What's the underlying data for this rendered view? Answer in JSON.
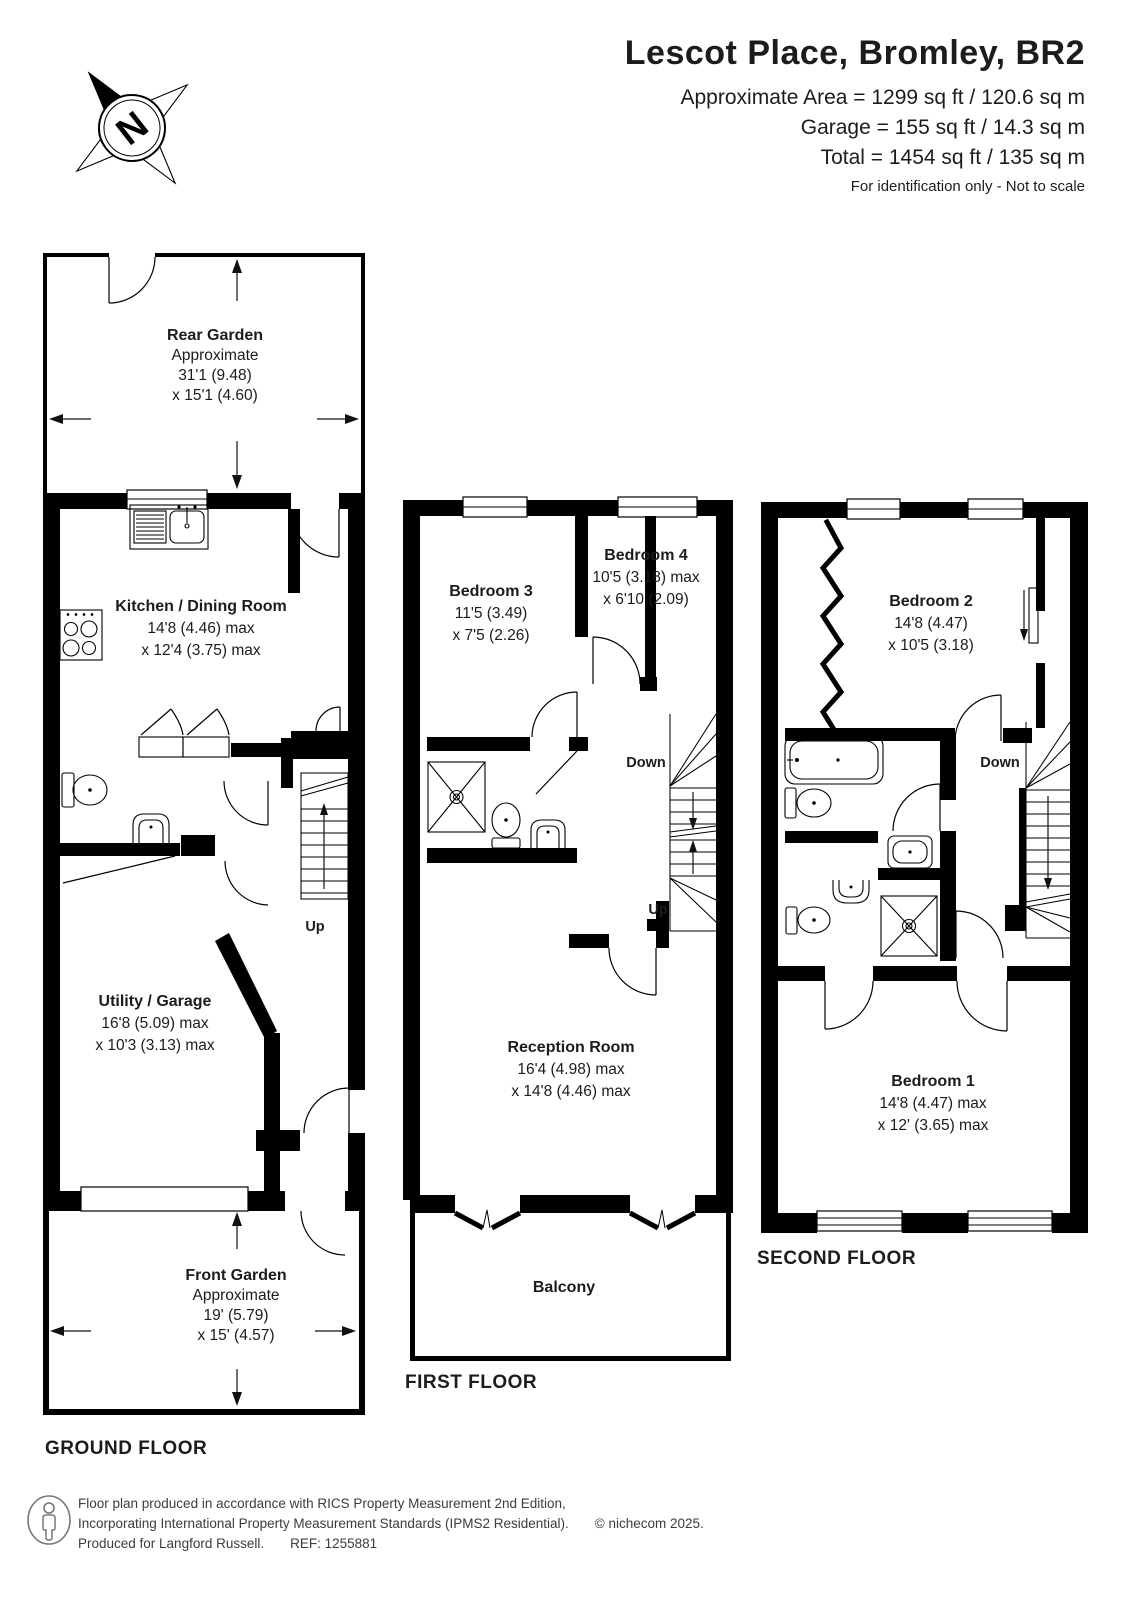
{
  "header": {
    "title": "Lescot Place, Bromley, BR2",
    "area_line1": "Approximate Area = 1299 sq ft / 120.6 sq m",
    "area_line2": "Garage = 155 sq ft / 14.3 sq m",
    "area_line3": "Total = 1454 sq ft / 135 sq m",
    "disclaimer": "For identification only - Not to scale"
  },
  "compass": {
    "north_label": "N"
  },
  "floors": {
    "ground": {
      "label": "GROUND FLOOR",
      "up_label": "Up",
      "rooms": {
        "rear_garden": {
          "name": "Rear Garden",
          "lines": [
            "Approximate",
            "31'1 (9.48)",
            "x 15'1 (4.60)"
          ]
        },
        "kitchen": {
          "name": "Kitchen / Dining Room",
          "lines": [
            "14'8 (4.46) max",
            "x 12'4 (3.75) max"
          ]
        },
        "utility": {
          "name": "Utility / Garage",
          "lines": [
            "16'8 (5.09) max",
            "x 10'3 (3.13) max"
          ]
        },
        "front_garden": {
          "name": "Front Garden",
          "lines": [
            "Approximate",
            "19' (5.79)",
            "x 15' (4.57)"
          ]
        }
      }
    },
    "first": {
      "label": "FIRST FLOOR",
      "down_label": "Down",
      "up_label": "Up",
      "rooms": {
        "bedroom3": {
          "name": "Bedroom 3",
          "lines": [
            "11'5 (3.49)",
            "x 7'5 (2.26)"
          ]
        },
        "bedroom4": {
          "name": "Bedroom 4",
          "lines": [
            "10'5 (3.18) max",
            "x 6'10 (2.09)"
          ]
        },
        "reception": {
          "name": "Reception Room",
          "lines": [
            "16'4 (4.98) max",
            "x 14'8 (4.46) max"
          ]
        },
        "balcony": {
          "name": "Balcony"
        }
      }
    },
    "second": {
      "label": "SECOND FLOOR",
      "down_label": "Down",
      "rooms": {
        "bedroom2": {
          "name": "Bedroom 2",
          "lines": [
            "14'8 (4.47)",
            "x 10'5 (3.18)"
          ]
        },
        "bedroom1": {
          "name": "Bedroom 1",
          "lines": [
            "14'8 (4.47) max",
            "x 12' (3.65) max"
          ]
        }
      }
    }
  },
  "footer": {
    "line1": "Floor plan produced in accordance with RICS Property Measurement 2nd Edition,",
    "line2": "Incorporating International Property Measurement Standards (IPMS2 Residential).",
    "copyright": "© nichecom 2025.",
    "line3": "Produced for Langford Russell.",
    "ref": "REF: 1255881"
  },
  "colors": {
    "wall": "#000000",
    "text": "#1c1c1c",
    "background": "#ffffff"
  }
}
